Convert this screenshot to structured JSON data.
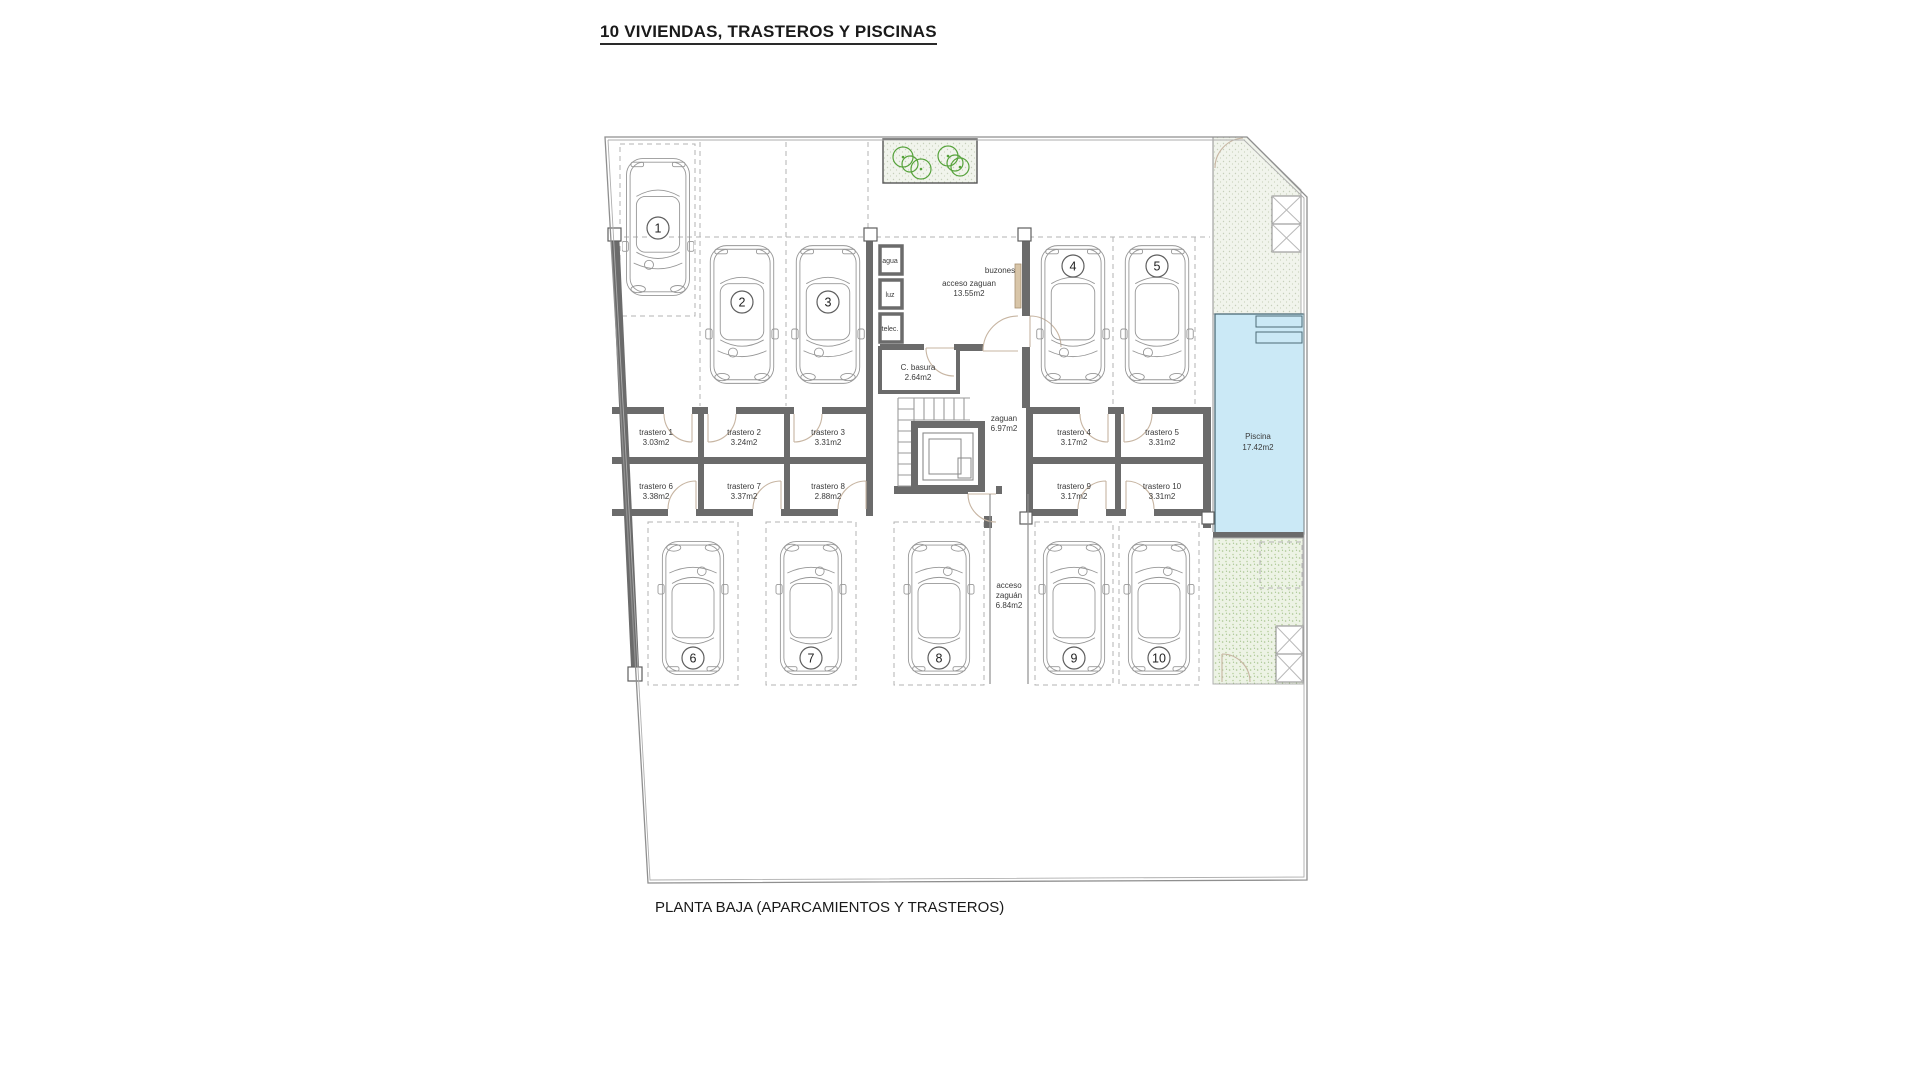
{
  "title": "10 VIVIENDAS, TRASTEROS Y PISCINAS",
  "caption": "PLANTA BAJA (APARCAMIENTOS Y TRASTEROS)",
  "colors": {
    "pool_fill": "#cbe9f6",
    "pool_edge": "#4c6b77",
    "wall": "#6b6b6b",
    "green_dot": "#a9c493",
    "plant": "#57a33c",
    "mailbox_panel": "#d8c5a8"
  },
  "parking_spots": [
    {
      "number": "1"
    },
    {
      "number": "2"
    },
    {
      "number": "3"
    },
    {
      "number": "4"
    },
    {
      "number": "5"
    },
    {
      "number": "6"
    },
    {
      "number": "7"
    },
    {
      "number": "8"
    },
    {
      "number": "9"
    },
    {
      "number": "10"
    }
  ],
  "trasteros": [
    {
      "name": "trastero 1",
      "area": "3.03m2"
    },
    {
      "name": "trastero 2",
      "area": "3.24m2"
    },
    {
      "name": "trastero 3",
      "area": "3.31m2"
    },
    {
      "name": "trastero 4",
      "area": "3.17m2"
    },
    {
      "name": "trastero 5",
      "area": "3.31m2"
    },
    {
      "name": "trastero 6",
      "area": "3.38m2"
    },
    {
      "name": "trastero 7",
      "area": "3.37m2"
    },
    {
      "name": "trastero 8",
      "area": "2.88m2"
    },
    {
      "name": "trastero 9",
      "area": "3.17m2"
    },
    {
      "name": "trastero 10",
      "area": "3.31m2"
    }
  ],
  "rooms": {
    "acceso_zaguan_top": {
      "name": "acceso zaguan",
      "area": "13.55m2"
    },
    "zaguan": {
      "name": "zaguan",
      "area": "6.97m2"
    },
    "acceso_zaguan_lower": {
      "line1": "acceso",
      "line2": "zaguán",
      "line3": "6.84m2"
    },
    "c_basura": {
      "name": "C. basura",
      "area": "2.64m2"
    },
    "piscina": {
      "name": "Piscina",
      "area": "17.42m2"
    },
    "buzones_label": "buzones",
    "utilities": [
      "agua",
      "luz",
      "telec."
    ]
  }
}
